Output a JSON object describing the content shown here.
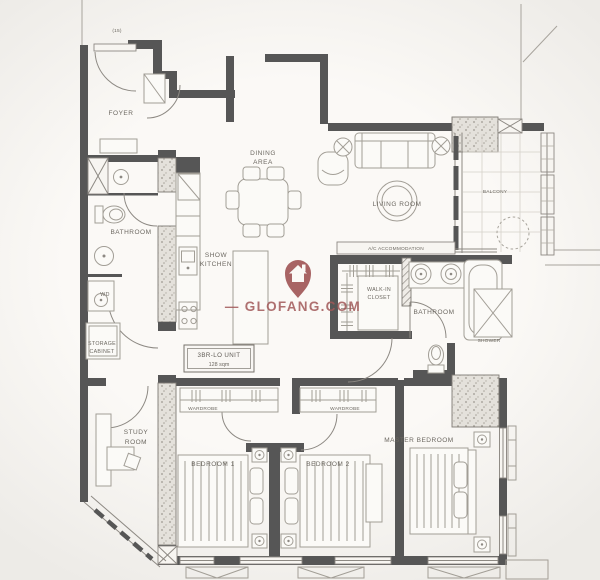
{
  "watermark": {
    "label": "— GLOFANG.COM",
    "color": "#a15858"
  },
  "unit_box": {
    "title": "3BR-LO UNIT",
    "area": "128 sqm"
  },
  "annotations": {
    "entrance": "(15)",
    "ac_ledge": "A/C ACCOMMODATION",
    "shower": "SHOWER",
    "wd": "WD"
  },
  "rooms": {
    "foyer": "FOYER",
    "dining_line1": "DINING",
    "dining_line2": "AREA",
    "living": "LIVING ROOM",
    "balcony": "BALCONY",
    "kitchen_line1": "SHOW",
    "kitchen_line2": "KITCHEN",
    "bathroom1": "BATHROOM",
    "storage_line1": "STORAGE",
    "storage_line2": "CABINET",
    "walkin_line1": "WALK-IN",
    "walkin_line2": "CLOSET",
    "bathroom2": "BATHROOM",
    "study_line1": "STUDY",
    "study_line2": "ROOM",
    "wardrobe1": "WARDROBE",
    "wardrobe2": "WARDROBE",
    "bedroom1": "BEDROOM 1",
    "bedroom2": "BEDROOM 2",
    "master": "MASTER BEDROOM"
  }
}
